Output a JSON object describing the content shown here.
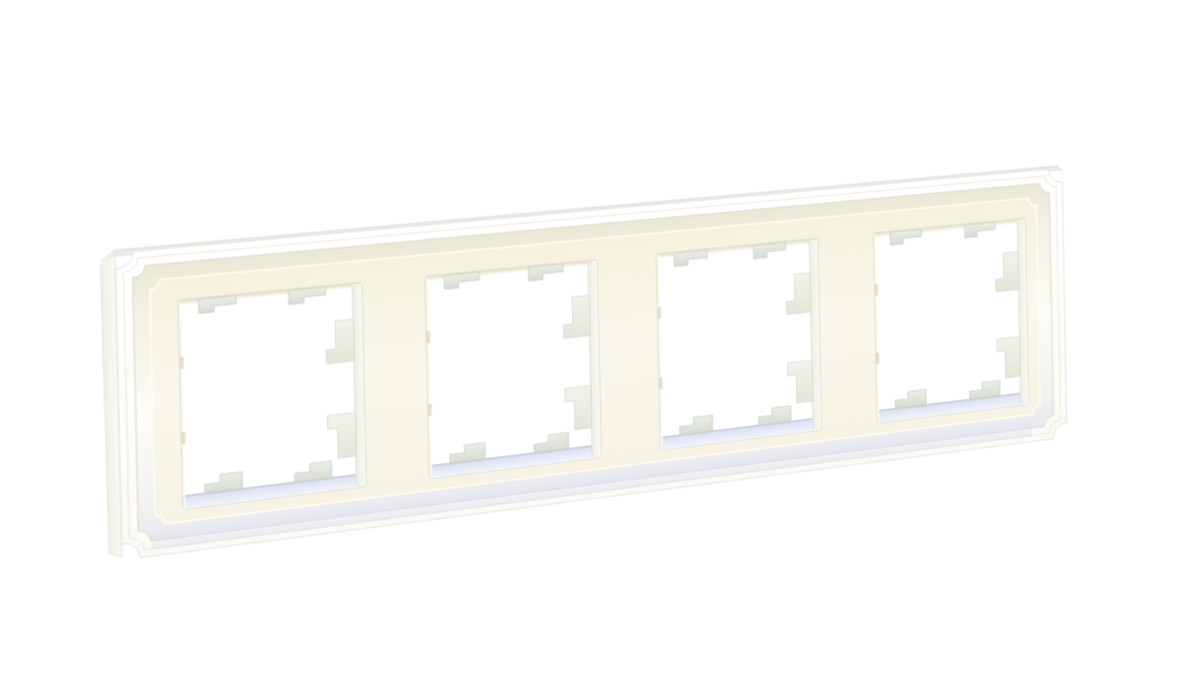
{
  "image": {
    "subject": "White four-gang decorative wall switch frame with classical molded scalloped corners, photographed at a slight angle on a plain white background",
    "type": "product-photo",
    "background": "#ffffff"
  },
  "product": {
    "gang_count": 4,
    "finish": "matte white / cream",
    "style": "classic molded border with concave corner notches",
    "features": [
      "four square module openings",
      "two hanging clip tabs on the top edge of each opening",
      "two standing clip tabs on the bottom edge of each opening",
      "two stepped latch tabs on the right inner wall of each opening",
      "two small notches on the left inner wall of each opening"
    ]
  },
  "palette": {
    "bg": "#ffffff",
    "mold_top": "#ffffff",
    "mold_bottom": "#fbfaf4",
    "cove_top": "#eae8d5",
    "cove_upper": "#f4f2e3",
    "cove_mid": "#fdfcf6",
    "cove_lower": "#f1f1ee",
    "cove_bottom": "#e9e9f2",
    "face_top": "#f4f1de",
    "face_mid": "#faf8ec",
    "face_bottom": "#f6f3e4",
    "hole": "#ffffff",
    "hole_rim": "#d9d4bd",
    "shade_tan": "#dcd5ba",
    "wall_left": "#ecefe3",
    "wall_right": "#f8f9f3",
    "wall_edge": "#d8dbcc",
    "wallb_top": "#dbe0ef",
    "wallb_bottom": "#f2f4fb",
    "lav_line": "#c7cde7",
    "tab_light": "#eaeee6",
    "tab_dark": "#d8ddd3",
    "tab_edge": "#c4cac1",
    "tabbig_light": "#f1f3ea",
    "tabbig_dark": "#e3e7d9",
    "tabbig_edge": "#d2d7c8",
    "notch": "#ddd7c0",
    "left_glow": "#fcfaf0",
    "flank_outer": "#f0eee1",
    "flank_inner": "#fbfbf4",
    "flank_edge": "#dadcd2",
    "flanktop_a": "#e4e7e2",
    "flanktop_b": "#f6f7f4",
    "tint": "#dcdcee",
    "outer_edge": "#e0e4e1",
    "ridge1": "#ebe9da",
    "ridge2": "#dcd8c6",
    "face_rim": "#fffdf4"
  },
  "scene": {
    "flat_width": 950,
    "flat_height": 300,
    "rings": [
      {
        "inset": 0,
        "corner_radius": 16,
        "fill": "url(#gOuter)",
        "stroke": "outer_edge",
        "stroke_width": 1,
        "name": "frame-outer-molding"
      },
      {
        "inset": 7,
        "corner_radius": 13,
        "fill": "none",
        "stroke": "ridge1",
        "stroke_width": 1,
        "name": "frame-ridge-line"
      },
      {
        "inset": 15,
        "corner_radius": 11,
        "fill": "url(#gCove)",
        "stroke": "ridge2",
        "stroke_width": 1,
        "name": "frame-cove-band"
      },
      {
        "inset": 30,
        "corner_radius": 9,
        "fill": "url(#gFace)",
        "stroke": "face_rim",
        "stroke_width": 1.6,
        "name": "frame-face-plate"
      }
    ],
    "flank": {
      "width": 13
    },
    "bottom_sheen": {
      "x": 26,
      "y": 271,
      "w": 884,
      "h": 23
    },
    "openings": {
      "count": 4,
      "starts": [
        55,
        283,
        511,
        739
      ],
      "top": 52,
      "width": 168,
      "height": 206,
      "right_wall_x": 159,
      "bottom_wall_y": 192,
      "bottom_wall_h": 13,
      "top_tabs": {
        "x": [
          18,
          100
        ],
        "w": 34,
        "bar_h": 8,
        "foot_w": 14,
        "foot_h": 6
      },
      "bottom_tabs": {
        "x": [
          20,
          102
        ],
        "w": 34,
        "foot_w": 14,
        "foot_h": 9,
        "step": 8,
        "base_y": 193
      },
      "side_tabs": {
        "attach_x": 159.5,
        "narrow_w": 17,
        "foot_w": 26,
        "upper": [
          36,
          64,
          78
        ],
        "lower": [
          130,
          144,
          174
        ]
      },
      "notches": {
        "y": [
          56,
          130
        ],
        "w": 3.5,
        "h": 12
      }
    }
  }
}
